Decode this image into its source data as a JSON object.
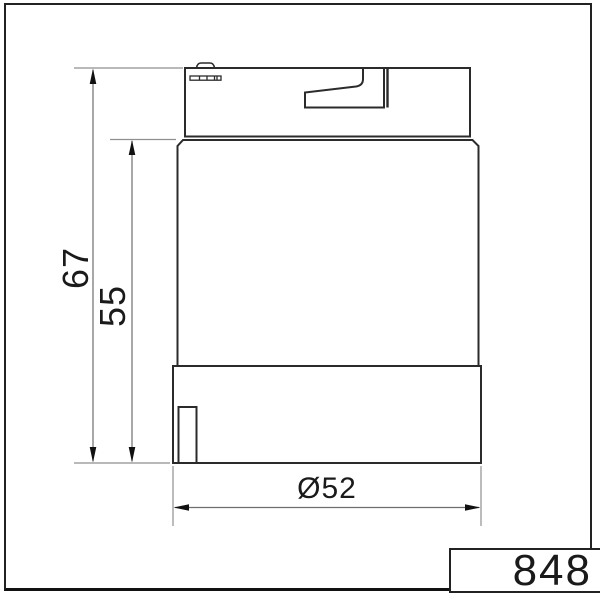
{
  "drawing": {
    "type": "technical-dimension-drawing",
    "subject": "signal-tower-element-side-view",
    "part_label": "848",
    "dimensions": {
      "overall_height": "67",
      "lens_height": "55",
      "diameter": "Ø52"
    },
    "colors": {
      "background": "#ffffff",
      "outline": "#2b2b2b",
      "dimension_line": "#6e6e6e",
      "extension_line": "#8f8f8f",
      "arrow": "#111111",
      "frame": "#222222",
      "text": "#1a1a1a"
    }
  }
}
